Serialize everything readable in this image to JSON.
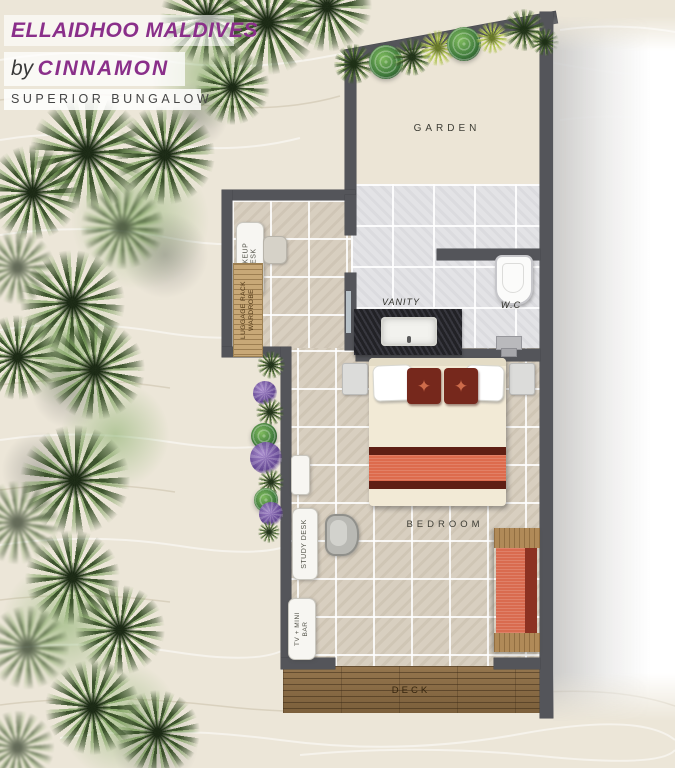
{
  "header": {
    "title": "ELLAIDHOO MALDIVES",
    "by": "by",
    "brand": "CINNAMON",
    "room_type": "SUPERIOR BUNGALOW"
  },
  "rooms": {
    "garden": "GARDEN",
    "vanity": "VANITY",
    "wc": "W.C",
    "bedroom": "BEDROOM",
    "deck": "DECK"
  },
  "furniture": {
    "makeup_desk_line1": "MAKEUP",
    "makeup_desk_line2": "DESK",
    "wardrobe_line1": "LUGGAGE RACK",
    "wardrobe_line2": "WARDROBE",
    "study_desk": "STUDY DESK",
    "tv_minibar_line1": "TV + MINI",
    "tv_minibar_line2": "BAR"
  },
  "icons": {
    "star": "✦"
  },
  "colors": {
    "brand_purple": "#8a2f8a",
    "wall": "#54555a",
    "sand": "#ece6d8",
    "bath_tile": "#e3e3e6",
    "floor_tile": "#d8cfc0",
    "deck_wood": "#8a6c46",
    "bed_runner_orange": "#dd6b4d",
    "pillow_maroon": "#76281c",
    "plant_green": "#4a6b33",
    "flower_purple": "#6f4f9b"
  }
}
